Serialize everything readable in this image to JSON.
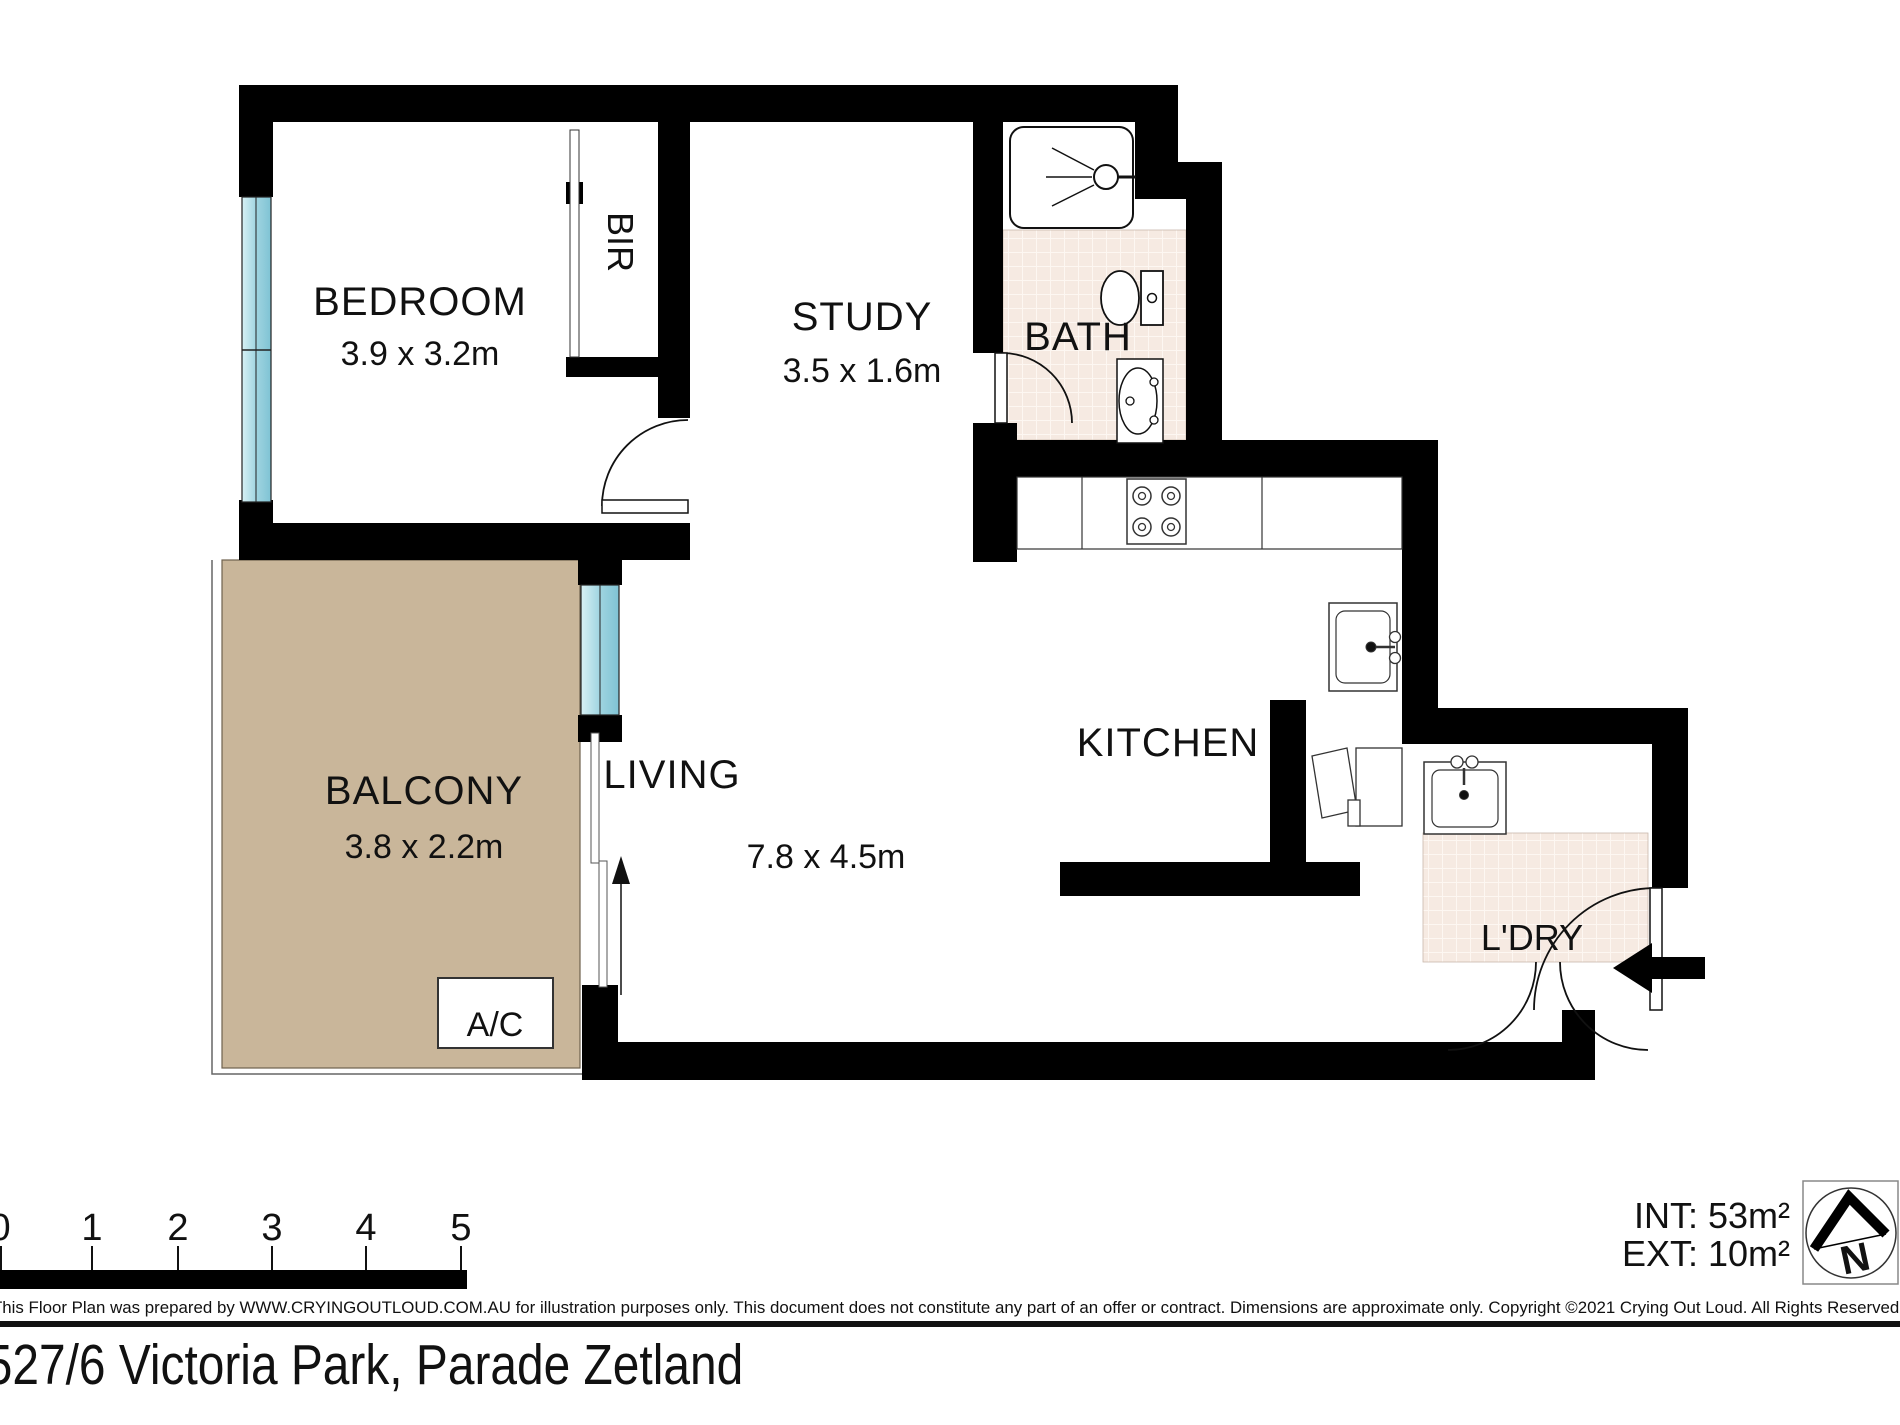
{
  "title": {
    "address": "527/6 Victoria Park, Parade Zetland"
  },
  "rooms": [
    {
      "name": "BEDROOM",
      "dims": "3.9 x 3.2m"
    },
    {
      "name": "STUDY",
      "dims": "3.5 x 1.6m"
    },
    {
      "name": "BATH"
    },
    {
      "name": "KITCHEN"
    },
    {
      "name": "LIVING",
      "dims": "7.8 x 4.5m"
    },
    {
      "name": "BALCONY",
      "dims": "3.8 x 2.2m"
    },
    {
      "name": "L'DRY"
    },
    {
      "name": "BIR"
    },
    {
      "name": "A/C"
    }
  ],
  "areas": {
    "internal": "INT: 53m²",
    "external": "EXT: 10m²"
  },
  "scale_bar": {
    "labels": [
      "0",
      "1",
      "2",
      "3",
      "4",
      "5"
    ]
  },
  "compass": {
    "label": "N"
  },
  "icons": {
    "entry_arrow_direction": "left",
    "balcony_door_arrow_direction": "up"
  },
  "footer": {
    "disclaimer": "This Floor Plan was prepared by WWW.CRYINGOUTLOUD.COM.AU for illustration purposes only. This document does not constitute any part of an offer or contract. Dimensions are approximate only. Copyright ©2021 Crying Out Loud. All Rights Reserved."
  },
  "colors": {
    "wall": "#000000",
    "window": "#9fd4e0",
    "balcony": "#c9b69a",
    "tile": "#f6eae2"
  }
}
